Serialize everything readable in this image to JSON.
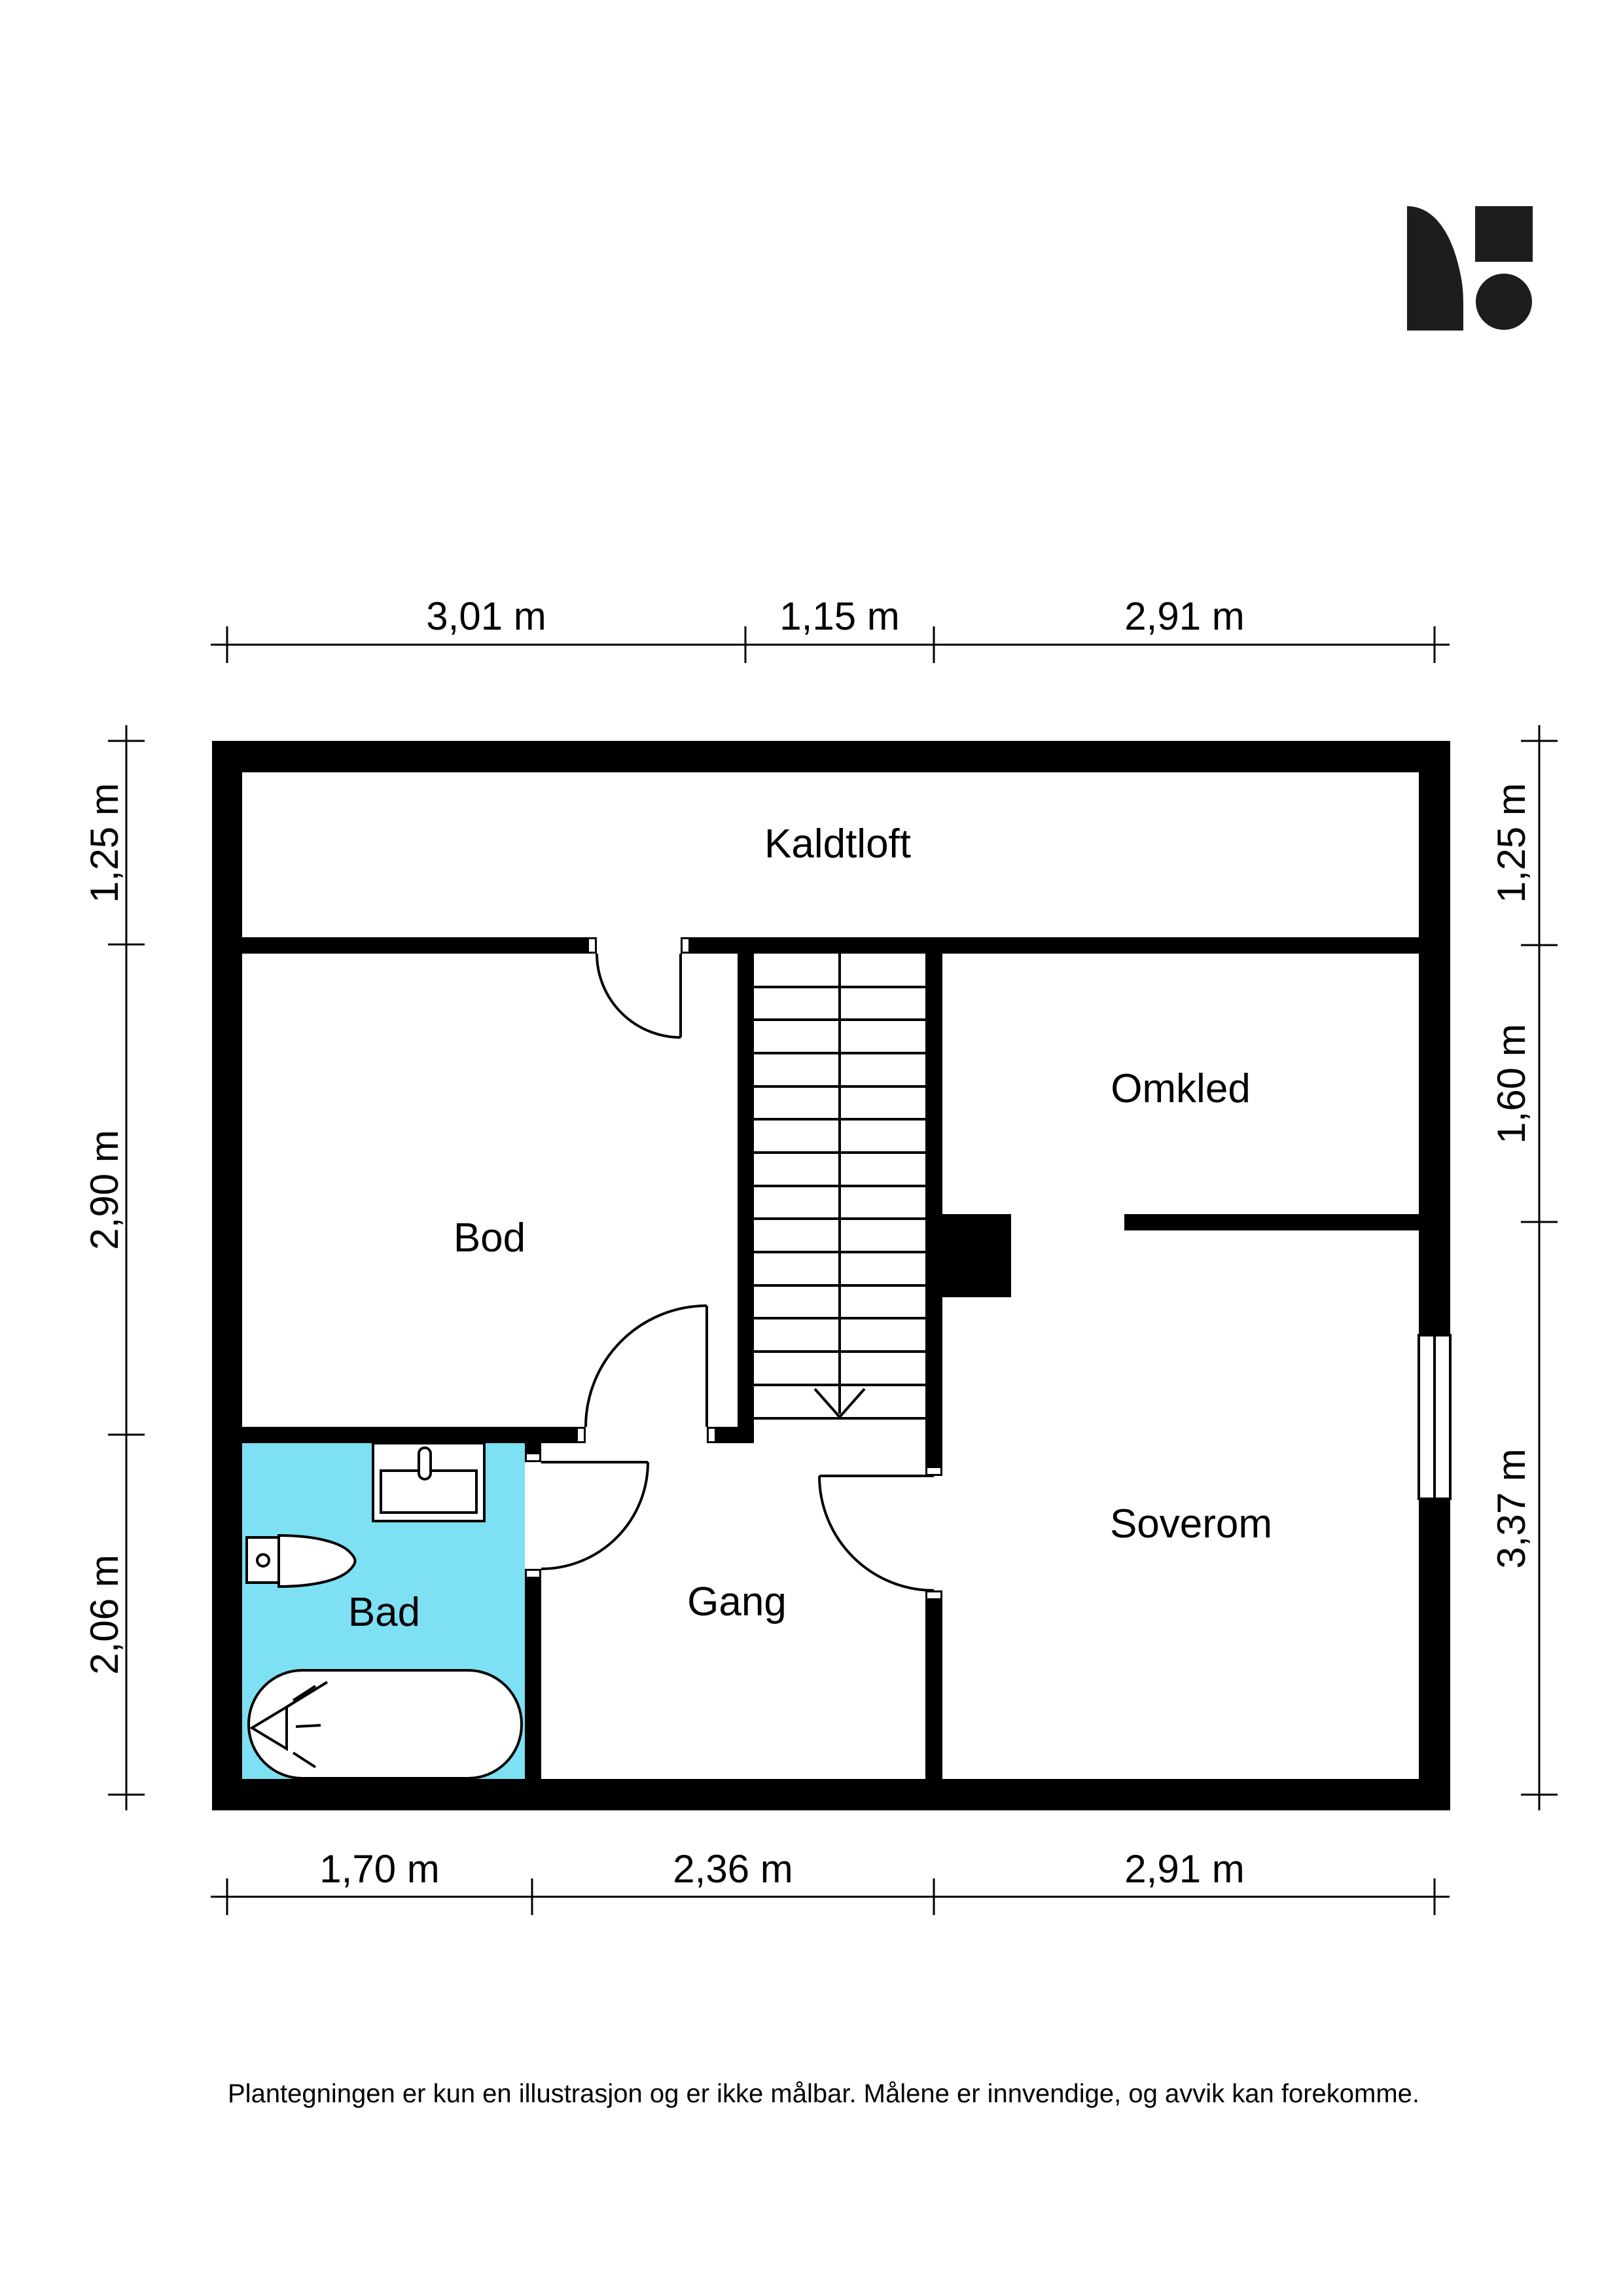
{
  "colors": {
    "ink": "#000000",
    "bathroom_fill": "#7EE0F3",
    "background": "#ffffff",
    "logo": "#1d1d1b"
  },
  "rooms": [
    {
      "id": "kaldtloft",
      "label": "Kaldtloft"
    },
    {
      "id": "bod",
      "label": "Bod"
    },
    {
      "id": "omkled",
      "label": "Omkled"
    },
    {
      "id": "soverom",
      "label": "Soverom"
    },
    {
      "id": "gang",
      "label": "Gang"
    },
    {
      "id": "bad",
      "label": "Bad"
    }
  ],
  "dimensions": {
    "top": [
      "3,01 m",
      "1,15 m",
      "2,91 m"
    ],
    "left": [
      "1,25 m",
      "2,90 m",
      "2,06 m"
    ],
    "right": [
      "1,25 m",
      "1,60 m",
      "3,37 m"
    ],
    "bottom": [
      "1,70 m",
      "2,36 m",
      "2,91 m"
    ]
  },
  "disclaimer": "Plantegningen er kun en illustrasjon og er ikke målbar. Målene er innvendige, og avvik kan forekomme."
}
